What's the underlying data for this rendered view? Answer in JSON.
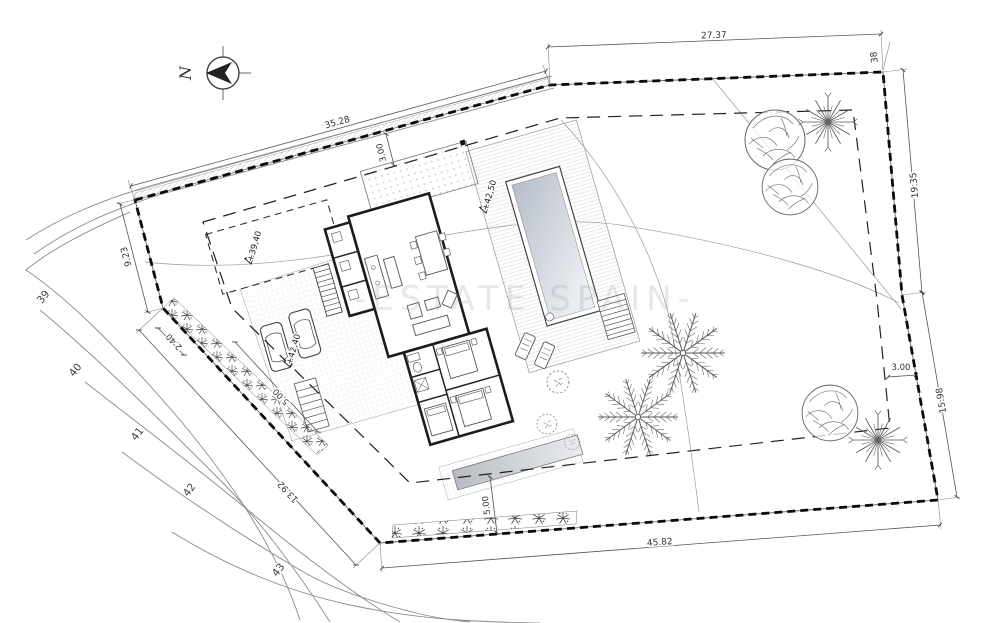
{
  "plan": {
    "watermark": "-ESTATE SPAIN-",
    "north": {
      "label": "N"
    },
    "boundary_point": "38",
    "dimensions": {
      "top_left_edge": "35.28",
      "top_right_edge": "27.37",
      "top_setback": "3.00",
      "left_edge": "9.23",
      "hedge_offset": "2.40",
      "hedge_width": "5.00",
      "sw_edge": "13.92",
      "right_upper_edge": "19.35",
      "right_setback": "3.00",
      "right_lower_edge": "15.98",
      "bottom_edge": "45.82",
      "bottom_setback": "5.00"
    },
    "spot_elevations": {
      "pool_terrace": "+42,50",
      "upper_plateau": "+39,40",
      "driveway": "+42,40"
    },
    "contour_labels": [
      "39",
      "40",
      "41",
      "42",
      "43"
    ],
    "colors": {
      "paper": "#ffffff",
      "line": "#3a3a3a",
      "boundary": "#0b0b0b",
      "pool_dark": "#b6bdc9",
      "pool_light": "#eaedf1",
      "watermark": "rgba(128,138,152,0.20)"
    }
  }
}
